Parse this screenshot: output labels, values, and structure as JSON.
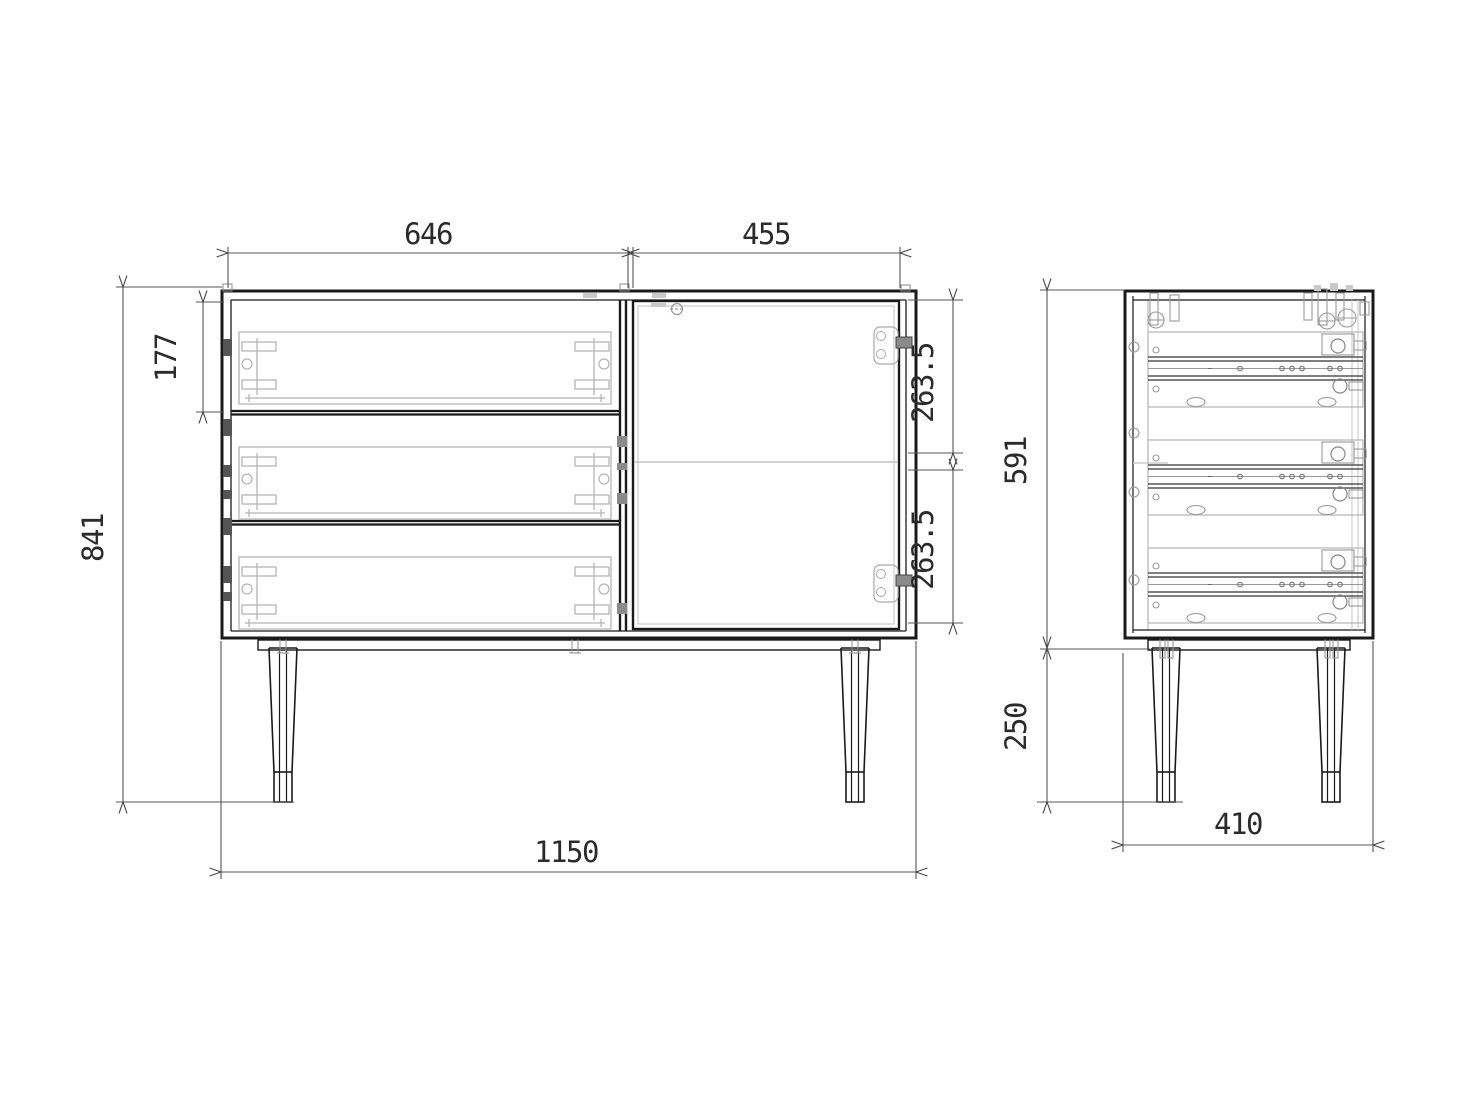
{
  "drawing": {
    "type": "furniture-technical-drawing",
    "palette": {
      "main_line": "#1a1a1a",
      "dimension_line": "#555555",
      "hardware_light": "#b5b5b5",
      "hardware_dark": "#777777",
      "background": "#ffffff"
    },
    "views": {
      "front": {
        "dims": {
          "drawer_section_width": "646",
          "door_width": "455",
          "top_drawer_height": "177",
          "overall_height": "841",
          "door_upper_section": "263.5",
          "door_lower_section": "263.5",
          "overall_width": "1150"
        }
      },
      "side": {
        "dims": {
          "carcass_height": "591",
          "leg_height": "250",
          "depth": "410"
        }
      }
    }
  }
}
